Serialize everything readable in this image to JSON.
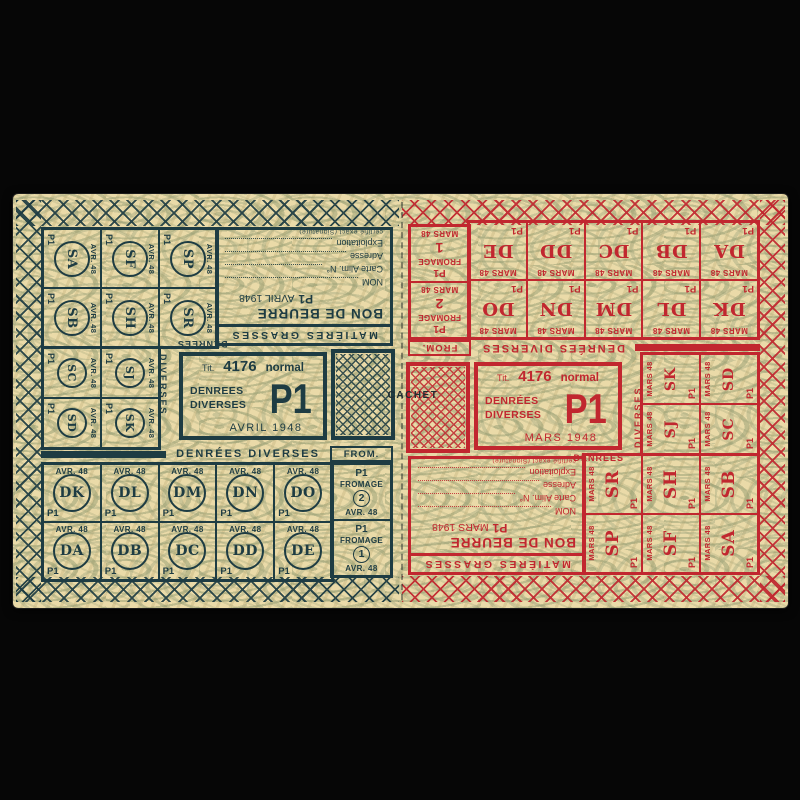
{
  "stage": {
    "background": "#060606"
  },
  "paper": {
    "color": "#eadaa8",
    "pattern_color": "#949c72"
  },
  "cachet_label": "CACHET",
  "left": {
    "ink": "#1e3c43",
    "month": "AVR. 48",
    "p1": "P1",
    "stamps_a": [
      [
        "SA",
        "SF",
        "SP"
      ],
      [
        "SB",
        "SH",
        "SR"
      ]
    ],
    "stamps_b": [
      [
        "SC",
        "SJ"
      ],
      [
        "SD",
        "SK"
      ]
    ],
    "label_word1": "DENREES",
    "label_word2": "DIVERSES",
    "butter": {
      "header": "MATIÈRES GRASSES",
      "title": "BON DE BEURRE",
      "p1": "P1",
      "date": "AVRIL 1948",
      "fields": [
        "NOM",
        "Carte Alim. N°",
        "Adresse",
        "Exploitation"
      ],
      "note": "certifié exact (Signature)"
    },
    "title_block": {
      "tit": "Tit.",
      "num": "4176",
      "kind": "normal",
      "cat1": "DENREES",
      "cat2": "DIVERSES",
      "p1": "P1",
      "date": "AVRIL 1948"
    },
    "grid_header": "DENRÉES DIVERSES",
    "from_header": "FROM.",
    "grid": [
      [
        "DK",
        "DL",
        "DM",
        "DN",
        "DO"
      ],
      [
        "DA",
        "DB",
        "DC",
        "DD",
        "DE"
      ]
    ],
    "fromage": [
      {
        "p1": "P1",
        "word": "FROMAGE",
        "num": "2",
        "month": "AVR. 48"
      },
      {
        "p1": "P1",
        "word": "FROMAGE",
        "num": "1",
        "month": "AVR. 48"
      }
    ]
  },
  "right": {
    "ink": "#c1272f",
    "month": "MARS 48",
    "p1": "P1",
    "stamps_a": [
      [
        "SA",
        "SF",
        "SP"
      ],
      [
        "SB",
        "SH",
        "SR"
      ]
    ],
    "stamps_b": [
      [
        "SC",
        "SJ"
      ],
      [
        "SD",
        "SK"
      ]
    ],
    "label_word1": "DENRÉES",
    "label_word2": "DIVERSES",
    "butter": {
      "header": "MATIÈRES GRASSES",
      "title": "BON DE BEURRE",
      "p1": "P1",
      "date": "MARS 1948",
      "fields": [
        "NOM",
        "Carte Alim. N°",
        "Adresse",
        "Exploitation"
      ],
      "note": "certifié exact (Signature)"
    },
    "title_block": {
      "tit": "Tit.",
      "num": "4176",
      "kind": "normal",
      "cat1": "DENRÉES",
      "cat2": "DIVERSES",
      "p1": "P1",
      "date": "MARS 1948"
    },
    "grid_header": "DENRÉES DIVERSES",
    "from_header": "FROM.",
    "grid": [
      [
        "DK",
        "DL",
        "DM",
        "DN",
        "DO"
      ],
      [
        "DA",
        "DB",
        "DC",
        "DD",
        "DE"
      ]
    ],
    "fromage": [
      {
        "p1": "P1",
        "word": "FROMAGE",
        "num": "2",
        "month": "MARS 48"
      },
      {
        "p1": "P1",
        "word": "FROMAGE",
        "num": "1",
        "month": "MARS 48"
      }
    ]
  }
}
